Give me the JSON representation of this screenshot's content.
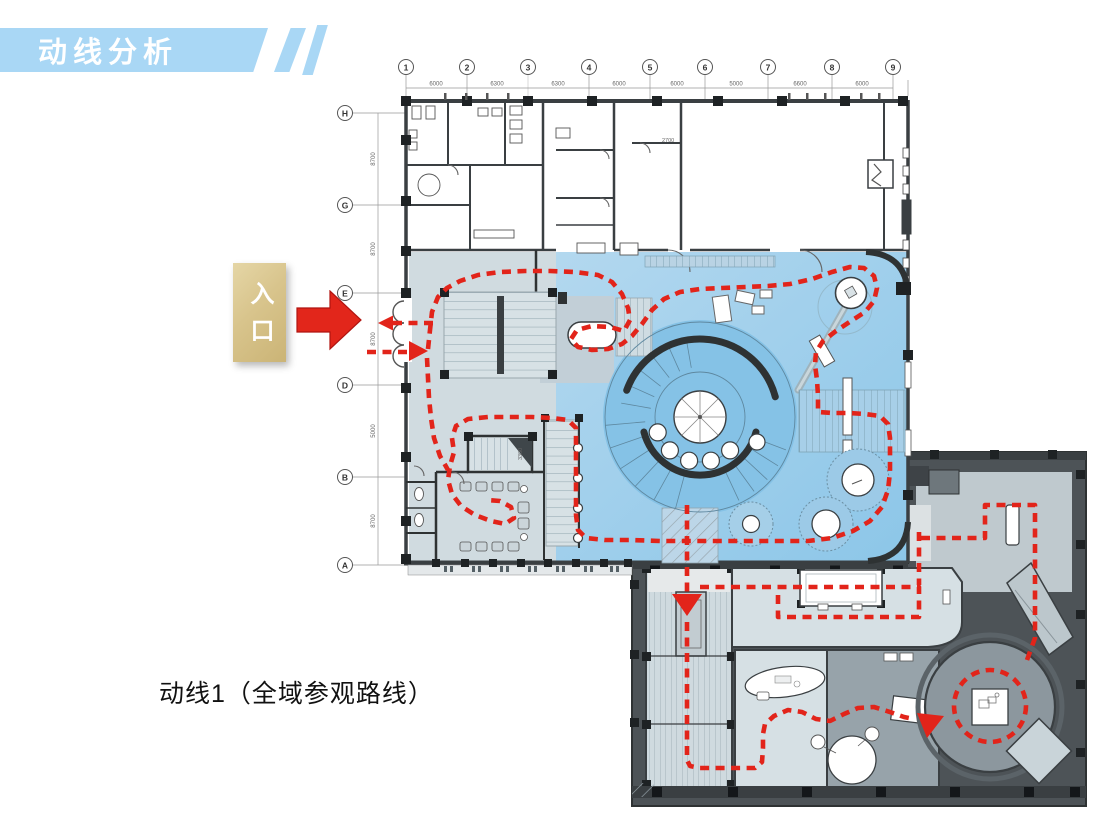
{
  "banner": {
    "title": "动线分析"
  },
  "entrance": {
    "label": "入口"
  },
  "caption": {
    "text": "动线1（全域参观路线）"
  },
  "plan": {
    "grid_top": {
      "labels": [
        "1",
        "2",
        "3",
        "4",
        "5",
        "6",
        "7",
        "8",
        "9"
      ],
      "dims": [
        "6000",
        "6300",
        "6300",
        "6000",
        "6000",
        "5000",
        "6600",
        "6000"
      ]
    },
    "grid_left": {
      "labels": [
        "H",
        "G",
        "E",
        "D",
        "B",
        "A"
      ],
      "dims": [
        "8700",
        "8700",
        "8700",
        "5000",
        "8700"
      ]
    },
    "annotations": {
      "stair_dim": "3300",
      "room_dim": "2700"
    }
  },
  "colors": {
    "banner_blue": "#A9D7F5",
    "entrance_tan": "#D8C48C",
    "route_red": "#E2241A",
    "wall_dark": "#2E3233",
    "hall_blue": "#9FCBE9",
    "hall_blue_bright": "#85C2E6",
    "lobby_gray_blue": "#D0DBE0",
    "room_gray_blue": "#C2CFD7",
    "annex_dark": "#4D5357",
    "annex_room_light": "#D6E0E4",
    "annex_room_gray": "#97A3AA",
    "circle_room_gray": "#8C979E"
  }
}
